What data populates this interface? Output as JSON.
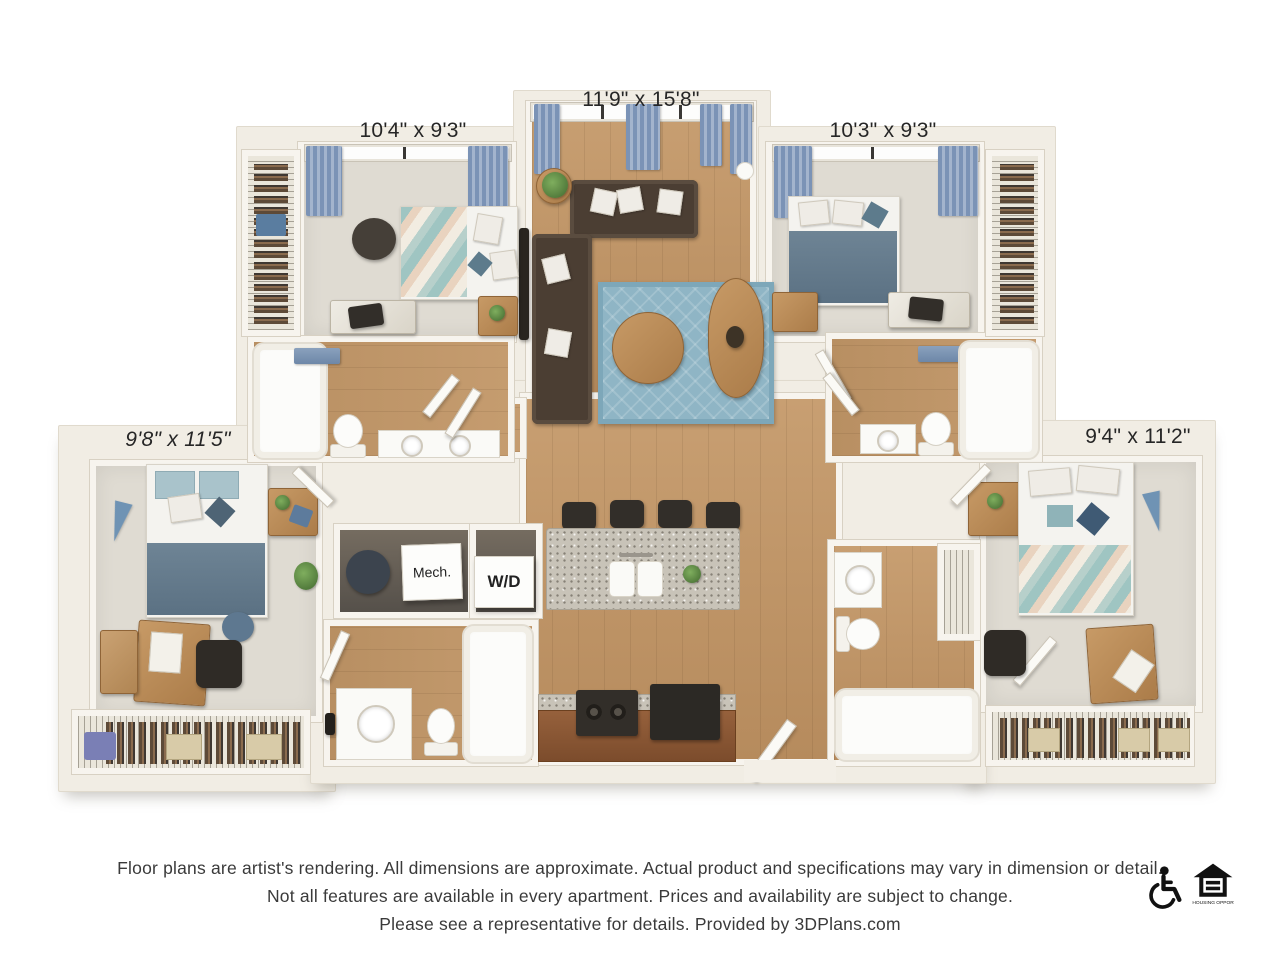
{
  "floor_plan": {
    "room_labels": {
      "bedroom_top_left": "10'4\" x 9'3\"",
      "living_room": "11'9\" x 15'8\"",
      "bedroom_top_right": "10'3\" x 9'3\"",
      "bedroom_left": "9'8\" x 11'5\"",
      "bedroom_right": "9'4\" x 11'2\""
    },
    "utility_labels": {
      "mechanical_closet": "Mech.",
      "washer_dryer": "W/D"
    },
    "colors": {
      "wall": "#f1ede4",
      "wood_floor": "#bd9365",
      "bedroom_carpet": "#dfdbd2",
      "area_rug_blue": "#8fb5c5",
      "sofa_brown": "#4b3e33",
      "curtain_blue": "#7b93b6",
      "bedding_blue": "#68808f",
      "granite_counter": "#c8c3b8",
      "cabinet_wood": "#8a5a39",
      "appliance_dark": "#322e29"
    }
  },
  "footer": {
    "disclaimer_lines": [
      "Floor plans are artist's rendering. All dimensions are approximate. Actual product and specifications may vary in dimension or detail.",
      "Not all features are available in every apartment. Prices and availability are subject to change.",
      "Please see a representative for details. Provided by 3DPlans.com"
    ],
    "equal_housing_text": "EQUAL HOUSING OPPORTUNITY",
    "icons": [
      "wheelchair-accessible-icon",
      "equal-housing-opportunity-icon"
    ]
  }
}
